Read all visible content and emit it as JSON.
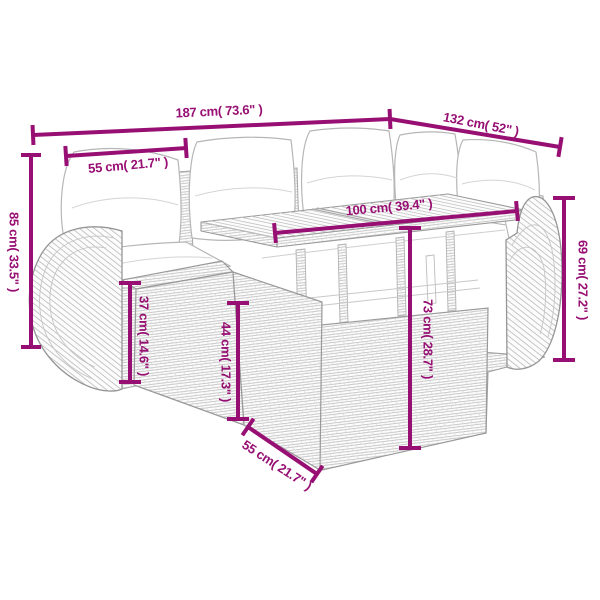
{
  "accent_color": "#970f73",
  "illustration": "rattan-corner-sofa-set-with-table-line-drawing",
  "dimensions": {
    "total_width": {
      "label": "187 cm( 73.6\" )"
    },
    "total_depth": {
      "label": "132 cm( 52\" )"
    },
    "back_height": {
      "label": "85 cm( 33.5\" )"
    },
    "seat_width": {
      "label": "55 cm( 21.7\" )"
    },
    "table_length": {
      "label": "100 cm( 39.4\" )"
    },
    "armrest_height": {
      "label": "69 cm( 27.2\" )"
    },
    "seat_height": {
      "label": "37 cm( 14.6\" )"
    },
    "table_height": {
      "label": "44 cm( 17.3\" )"
    },
    "sofa_front_height": {
      "label": "73 cm( 28.7\" )"
    },
    "seat_depth": {
      "label": "55 cm( 21.7\" )"
    }
  }
}
